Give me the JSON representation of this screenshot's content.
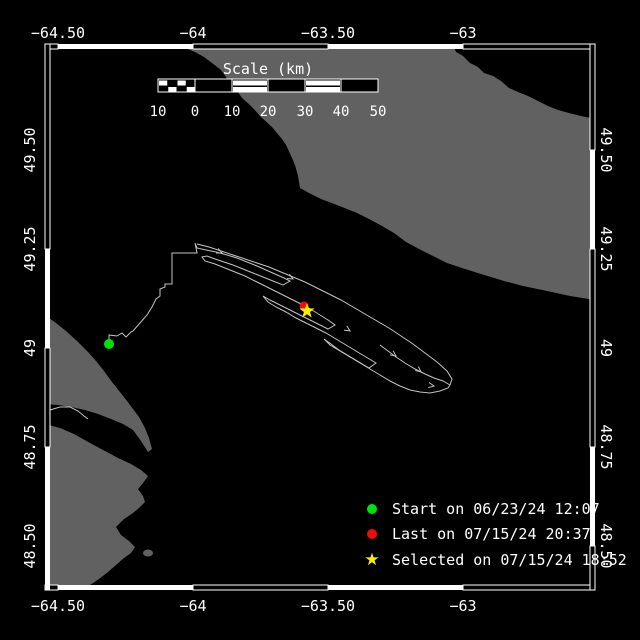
{
  "colors": {
    "background": "#000000",
    "land": "#616161",
    "water": "#000000",
    "frame": "#ffffff",
    "track": "#c3c3c3",
    "start": "#00e309",
    "last": "#f40b0b",
    "selected": "#ffee00"
  },
  "axes": {
    "top": {
      "y": 33,
      "labels": [
        {
          "text": "−64.50",
          "x": 58
        },
        {
          "text": "−64",
          "x": 193
        },
        {
          "text": "−63.50",
          "x": 328
        },
        {
          "text": "−63",
          "x": 463
        }
      ]
    },
    "bottom": {
      "y": 606,
      "labels": [
        {
          "text": "−64.50",
          "x": 58
        },
        {
          "text": "−64",
          "x": 193
        },
        {
          "text": "−63.50",
          "x": 328
        },
        {
          "text": "−63",
          "x": 463
        }
      ]
    },
    "left": {
      "x": 30,
      "labels": [
        {
          "text": "49.50",
          "y": 150
        },
        {
          "text": "49.25",
          "y": 249
        },
        {
          "text": "49",
          "y": 348
        },
        {
          "text": "48.75",
          "y": 447
        },
        {
          "text": "48.50",
          "y": 546
        }
      ]
    },
    "right": {
      "x": 606,
      "labels": [
        {
          "text": "49.50",
          "y": 150
        },
        {
          "text": "49.25",
          "y": 249
        },
        {
          "text": "49",
          "y": 348
        },
        {
          "text": "48.75",
          "y": 447
        },
        {
          "text": "48.50",
          "y": 546
        }
      ]
    }
  },
  "scalebar": {
    "title": "Scale (km)",
    "title_x": 268,
    "title_y": 69,
    "bar": {
      "x": 158,
      "y": 79,
      "w": 220,
      "h": 13
    },
    "checker": {
      "x": 158,
      "w": 37,
      "cols": 4
    },
    "segments": [
      {
        "x": 195,
        "w": 37,
        "type": "dark"
      },
      {
        "x": 232,
        "w": 36,
        "type": "light"
      },
      {
        "x": 268,
        "w": 37,
        "type": "dark"
      },
      {
        "x": 305,
        "w": 36,
        "type": "light"
      },
      {
        "x": 341,
        "w": 37,
        "type": "dark"
      }
    ],
    "labels_y": 112,
    "labels": [
      {
        "text": "10",
        "x": 158
      },
      {
        "text": "0",
        "x": 195
      },
      {
        "text": "10",
        "x": 232
      },
      {
        "text": "20",
        "x": 268
      },
      {
        "text": "30",
        "x": 305
      },
      {
        "text": "40",
        "x": 341
      },
      {
        "text": "50",
        "x": 378
      }
    ]
  },
  "legend": {
    "x": 363,
    "rows_y": [
      509,
      534,
      560
    ],
    "items": [
      {
        "marker": "dot",
        "color": "#00e309",
        "label": "Start on 06/23/24 12:07"
      },
      {
        "marker": "dot",
        "color": "#f40b0b",
        "label": "Last on 07/15/24 20:37"
      },
      {
        "marker": "star",
        "color": "#ffee00",
        "label": "Selected on 07/15/24 18:52"
      }
    ]
  },
  "map_data": {
    "frame": {
      "thickness": 5,
      "top": {
        "pos": 44,
        "segments": [
          {
            "from": 45,
            "to": 58,
            "fill": false
          },
          {
            "from": 58,
            "to": 193,
            "fill": true
          },
          {
            "from": 193,
            "to": 328,
            "fill": false
          },
          {
            "from": 328,
            "to": 463,
            "fill": true
          },
          {
            "from": 463,
            "to": 595,
            "fill": false
          }
        ]
      },
      "bottom": {
        "pos": 585,
        "segments": [
          {
            "from": 45,
            "to": 58,
            "fill": false
          },
          {
            "from": 58,
            "to": 193,
            "fill": true
          },
          {
            "from": 193,
            "to": 328,
            "fill": false
          },
          {
            "from": 328,
            "to": 463,
            "fill": true
          },
          {
            "from": 463,
            "to": 595,
            "fill": false
          }
        ]
      },
      "left": {
        "pos": 45,
        "segments": [
          {
            "from": 44,
            "to": 249,
            "fill": false
          },
          {
            "from": 249,
            "to": 348,
            "fill": true
          },
          {
            "from": 348,
            "to": 447,
            "fill": false
          },
          {
            "from": 447,
            "to": 590,
            "fill": true
          }
        ]
      },
      "right": {
        "pos": 590,
        "segments": [
          {
            "from": 44,
            "to": 150,
            "fill": false
          },
          {
            "from": 150,
            "to": 249,
            "fill": true
          },
          {
            "from": 249,
            "to": 447,
            "fill": false
          },
          {
            "from": 447,
            "to": 546,
            "fill": true
          },
          {
            "from": 546,
            "to": 590,
            "fill": false
          }
        ]
      }
    },
    "land_polygons": [
      {
        "name": "anticosti-island",
        "points": [
          [
            168,
            45
          ],
          [
            453,
            45
          ],
          [
            456,
            52
          ],
          [
            463,
            56
          ],
          [
            470,
            63
          ],
          [
            478,
            67
          ],
          [
            484,
            73
          ],
          [
            493,
            76
          ],
          [
            501,
            81
          ],
          [
            509,
            88
          ],
          [
            518,
            92
          ],
          [
            528,
            96
          ],
          [
            538,
            101
          ],
          [
            548,
            106
          ],
          [
            558,
            110
          ],
          [
            569,
            113
          ],
          [
            581,
            116
          ],
          [
            595,
            119
          ],
          [
            595,
            300
          ],
          [
            570,
            296
          ],
          [
            547,
            291
          ],
          [
            523,
            286
          ],
          [
            504,
            281
          ],
          [
            481,
            274
          ],
          [
            462,
            268
          ],
          [
            447,
            263
          ],
          [
            435,
            257
          ],
          [
            419,
            249
          ],
          [
            406,
            242
          ],
          [
            394,
            233
          ],
          [
            382,
            226
          ],
          [
            369,
            219
          ],
          [
            357,
            213
          ],
          [
            342,
            207
          ],
          [
            329,
            202
          ],
          [
            321,
            199
          ],
          [
            309,
            193
          ],
          [
            300,
            188
          ],
          [
            298,
            176
          ],
          [
            295,
            165
          ],
          [
            292,
            158
          ],
          [
            286,
            145
          ],
          [
            282,
            139
          ],
          [
            272,
            127
          ],
          [
            261,
            117
          ],
          [
            251,
            106
          ],
          [
            242,
            98
          ],
          [
            235,
            88
          ],
          [
            228,
            80
          ],
          [
            221,
            70
          ],
          [
            212,
            63
          ],
          [
            204,
            57
          ],
          [
            195,
            52
          ],
          [
            185,
            48
          ],
          [
            176,
            46
          ]
        ]
      },
      {
        "name": "gaspe-north-shore",
        "points": [
          [
            45,
            315
          ],
          [
            56,
            323
          ],
          [
            66,
            331
          ],
          [
            78,
            342
          ],
          [
            88,
            352
          ],
          [
            96,
            361
          ],
          [
            104,
            371
          ],
          [
            112,
            382
          ],
          [
            120,
            392
          ],
          [
            127,
            401
          ],
          [
            133,
            409
          ],
          [
            139,
            417
          ],
          [
            145,
            428
          ],
          [
            149,
            438
          ],
          [
            152,
            449
          ],
          [
            148,
            452
          ],
          [
            141,
            441
          ],
          [
            133,
            430
          ],
          [
            123,
            424
          ],
          [
            111,
            419
          ],
          [
            98,
            414
          ],
          [
            85,
            410
          ],
          [
            71,
            407
          ],
          [
            58,
            405
          ],
          [
            45,
            404
          ]
        ]
      },
      {
        "name": "gaspe-south-shore",
        "points": [
          [
            45,
            424
          ],
          [
            60,
            428
          ],
          [
            74,
            434
          ],
          [
            90,
            443
          ],
          [
            105,
            451
          ],
          [
            118,
            458
          ],
          [
            131,
            464
          ],
          [
            141,
            470
          ],
          [
            148,
            476
          ],
          [
            143,
            483
          ],
          [
            138,
            489
          ],
          [
            143,
            496
          ],
          [
            145,
            502
          ],
          [
            139,
            508
          ],
          [
            133,
            513
          ],
          [
            124,
            519
          ],
          [
            116,
            527
          ],
          [
            121,
            535
          ],
          [
            129,
            541
          ],
          [
            135,
            547
          ],
          [
            131,
            553
          ],
          [
            124,
            558
          ],
          [
            116,
            565
          ],
          [
            108,
            572
          ],
          [
            99,
            579
          ],
          [
            90,
            585
          ],
          [
            82,
            590
          ],
          [
            45,
            590
          ]
        ]
      }
    ],
    "islet": {
      "cx": 148,
      "cy": 553,
      "rx": 5,
      "ry": 3.5
    },
    "river": [
      [
        50,
        410
      ],
      [
        60,
        407
      ],
      [
        70,
        407
      ],
      [
        78,
        411
      ],
      [
        84,
        416
      ],
      [
        88,
        419
      ]
    ],
    "track": {
      "main": [
        [
          109,
          344
        ],
        [
          109,
          335
        ],
        [
          117,
          336
        ],
        [
          122,
          333
        ],
        [
          126,
          337
        ],
        [
          131,
          332
        ],
        [
          133,
          331
        ],
        [
          140,
          323
        ],
        [
          147,
          315
        ],
        [
          152,
          307
        ],
        [
          156,
          299
        ],
        [
          160,
          296
        ],
        [
          160,
          289
        ],
        [
          165,
          287
        ],
        [
          165,
          284
        ],
        [
          172,
          284
        ],
        [
          172,
          253
        ],
        [
          197,
          253
        ],
        [
          195,
          243
        ],
        [
          197,
          248
        ],
        [
          206,
          250
        ],
        [
          216,
          252
        ],
        [
          227,
          255
        ],
        [
          237,
          258
        ],
        [
          247,
          262
        ],
        [
          257,
          266
        ],
        [
          266,
          270
        ],
        [
          275,
          274
        ],
        [
          284,
          278
        ],
        [
          290,
          281
        ],
        [
          283,
          285
        ],
        [
          273,
          281
        ],
        [
          263,
          277
        ],
        [
          253,
          273
        ],
        [
          243,
          269
        ],
        [
          233,
          265
        ],
        [
          224,
          262
        ],
        [
          215,
          259
        ],
        [
          207,
          256
        ],
        [
          202,
          257
        ],
        [
          205,
          261
        ],
        [
          215,
          264
        ],
        [
          225,
          268
        ],
        [
          235,
          272
        ],
        [
          245,
          276
        ],
        [
          255,
          281
        ],
        [
          265,
          286
        ],
        [
          275,
          291
        ],
        [
          285,
          296
        ],
        [
          295,
          301
        ],
        [
          305,
          306
        ],
        [
          312,
          310
        ],
        [
          320,
          315
        ],
        [
          328,
          320
        ],
        [
          335,
          325
        ],
        [
          328,
          329
        ],
        [
          318,
          324
        ],
        [
          308,
          319
        ],
        [
          298,
          314
        ],
        [
          288,
          309
        ],
        [
          278,
          304
        ],
        [
          270,
          300
        ],
        [
          263,
          296
        ],
        [
          268,
          302
        ],
        [
          276,
          307
        ],
        [
          286,
          312
        ],
        [
          296,
          318
        ],
        [
          306,
          323
        ],
        [
          316,
          328
        ],
        [
          326,
          333
        ],
        [
          336,
          339
        ],
        [
          346,
          345
        ],
        [
          356,
          351
        ],
        [
          366,
          357
        ],
        [
          376,
          363
        ],
        [
          369,
          368
        ],
        [
          359,
          362
        ],
        [
          349,
          356
        ],
        [
          339,
          350
        ],
        [
          331,
          344
        ],
        [
          324,
          339
        ],
        [
          330,
          345
        ],
        [
          340,
          351
        ],
        [
          350,
          357
        ],
        [
          360,
          363
        ],
        [
          370,
          369
        ],
        [
          380,
          375
        ],
        [
          390,
          381
        ],
        [
          400,
          386
        ],
        [
          410,
          390
        ],
        [
          420,
          392
        ],
        [
          430,
          393
        ],
        [
          440,
          391
        ],
        [
          448,
          388
        ],
        [
          450,
          385
        ],
        [
          443,
          381
        ],
        [
          434,
          378
        ],
        [
          425,
          374
        ],
        [
          415,
          369
        ],
        [
          405,
          363
        ],
        [
          396,
          357
        ],
        [
          388,
          351
        ],
        [
          380,
          345
        ]
      ],
      "upper": [
        [
          197,
          244
        ],
        [
          209,
          247
        ],
        [
          221,
          251
        ],
        [
          233,
          255
        ],
        [
          245,
          259
        ],
        [
          257,
          263
        ],
        [
          269,
          267
        ],
        [
          281,
          272
        ],
        [
          293,
          277
        ],
        [
          305,
          282
        ],
        [
          317,
          288
        ],
        [
          329,
          294
        ],
        [
          341,
          300
        ],
        [
          353,
          307
        ],
        [
          365,
          314
        ],
        [
          377,
          321
        ],
        [
          389,
          328
        ],
        [
          401,
          336
        ],
        [
          413,
          344
        ],
        [
          425,
          353
        ],
        [
          437,
          362
        ],
        [
          447,
          371
        ],
        [
          452,
          379
        ],
        [
          450,
          385
        ]
      ]
    },
    "arrows": [
      {
        "x": 222,
        "y": 253,
        "a": 25
      },
      {
        "x": 293,
        "y": 279,
        "a": 28
      },
      {
        "x": 350,
        "y": 331,
        "a": 33
      },
      {
        "x": 396,
        "y": 356,
        "a": 36
      },
      {
        "x": 421,
        "y": 372,
        "a": 40
      },
      {
        "x": 434,
        "y": 386,
        "a": 10
      }
    ],
    "markers": {
      "start": {
        "x": 109,
        "y": 344,
        "r": 5
      },
      "last": {
        "x": 304,
        "y": 306,
        "r": 4.5
      },
      "selected": {
        "x": 307,
        "y": 311,
        "R": 8,
        "r": 3.2
      }
    }
  }
}
